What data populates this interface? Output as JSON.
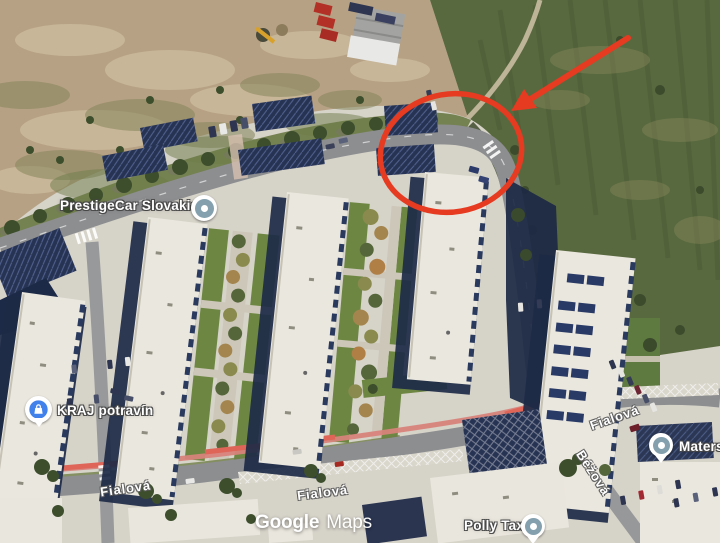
{
  "map": {
    "watermark": {
      "brand": "Google",
      "product": "Maps"
    },
    "pois": {
      "prestigecar": {
        "label": "PrestigeCar Slovakia",
        "marker": "poi-circle-marker"
      },
      "kraj": {
        "label": "KRAJ potravín",
        "marker": "shopping-bag-pin"
      },
      "materska": {
        "label": "Maters",
        "marker": "poi-circle-marker"
      },
      "polly": {
        "label": "Polly Taxi",
        "marker": "poi-circle-marker"
      }
    },
    "streets": {
      "fialova": "Fialová",
      "bezova": "Béžová"
    }
  },
  "annotation": {
    "color": "#e63a21",
    "shapes": [
      "ellipse-outline",
      "arrow"
    ]
  },
  "colors": {
    "field_green": "#59693f",
    "dirt_tan": "#b6a184",
    "road_gray": "#8d8e90",
    "roof_white": "#eae7de",
    "shadow_navy": "#1d2a47",
    "bike_lane_red": "#d8837b",
    "marker_blue": "#4081ec",
    "marker_slate": "#84a0ae"
  }
}
